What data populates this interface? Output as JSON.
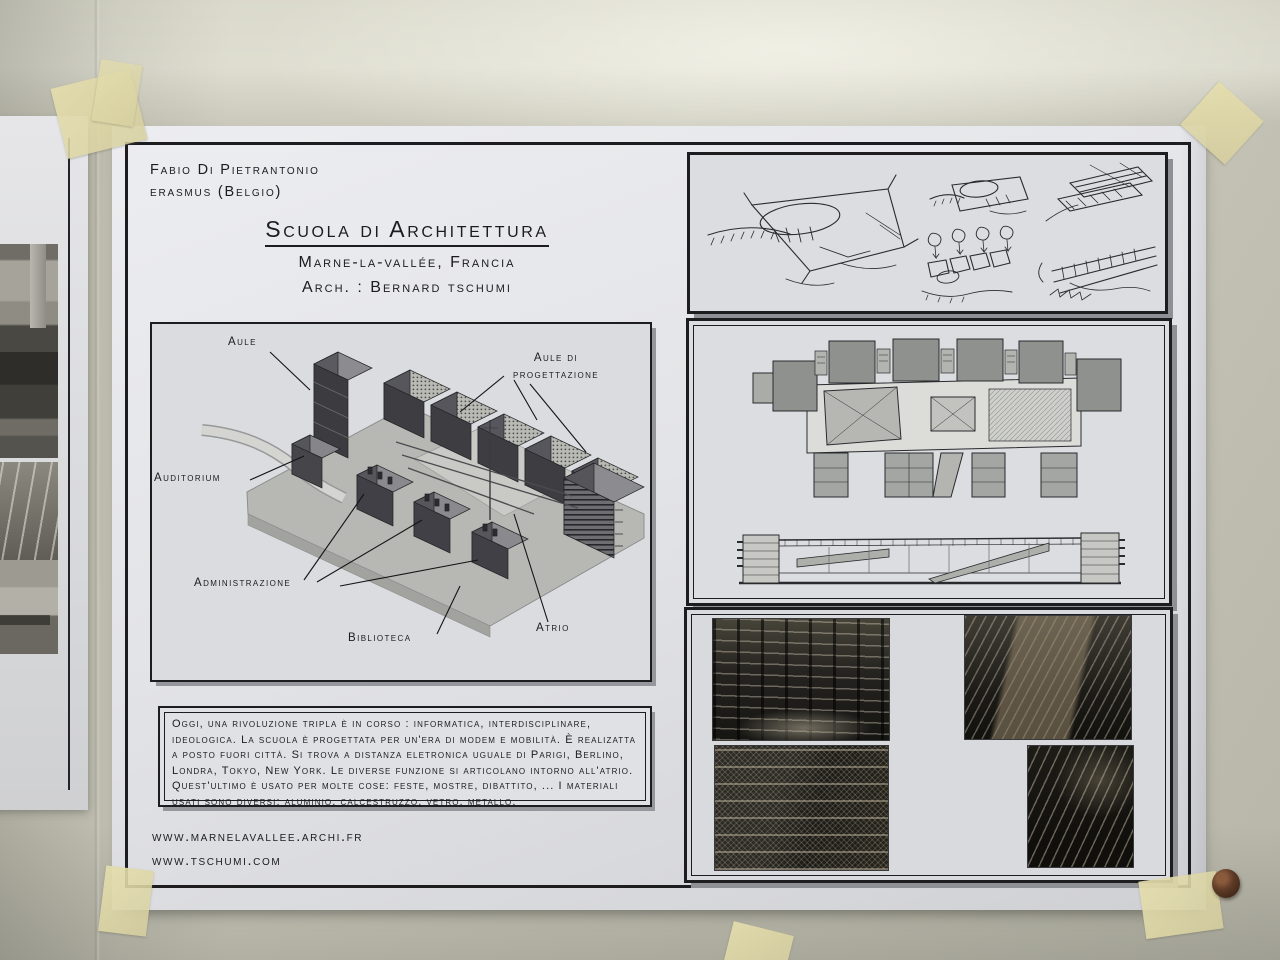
{
  "colors": {
    "wall": "#c6c5b8",
    "paper": "#e2e3e6",
    "ink": "#1c1c1e",
    "tape": "#ddd7ab",
    "pin_head": "#53341f",
    "panel_shadow": "#94959a"
  },
  "poster": {
    "author_line1": "Fabio Di Pietrantonio",
    "author_line2": "erasmus (Belgio)",
    "title": "Scuola di Architettura",
    "subtitle_location": "Marne-la-vallée, Francia",
    "subtitle_architect": "Arch. : Bernard tschumi",
    "axon_labels": {
      "aule": "Aule",
      "progettazione_line1": "Aule di",
      "progettazione_line2": "progettazione",
      "auditorium": "Auditorium",
      "administrazione": "Administrazione",
      "biblioteca": "Biblioteca",
      "atrio": "Atrio"
    },
    "description": "Oggi, una rivoluzione tripla è in corso : informatica, interdisciplinare, ideologica. La scuola è progettata per un'era di modem e mobilità. È realizatta a posto fuori città. Si trova a distanza eletronica uguale di Parigi, Berlino, Londra, Tokyo, New York. Le diverse funzione si articolano intorno all'atrio. Quest'ultimo è usato per molte cose: feste, mostre, dibattito, ... I materiali usati sono diversi: aluminio, calcestruzzo, vetro, metallo.",
    "website_1": "www.marnelavallee.archi.fr",
    "website_2": "www.tschumi.com"
  }
}
